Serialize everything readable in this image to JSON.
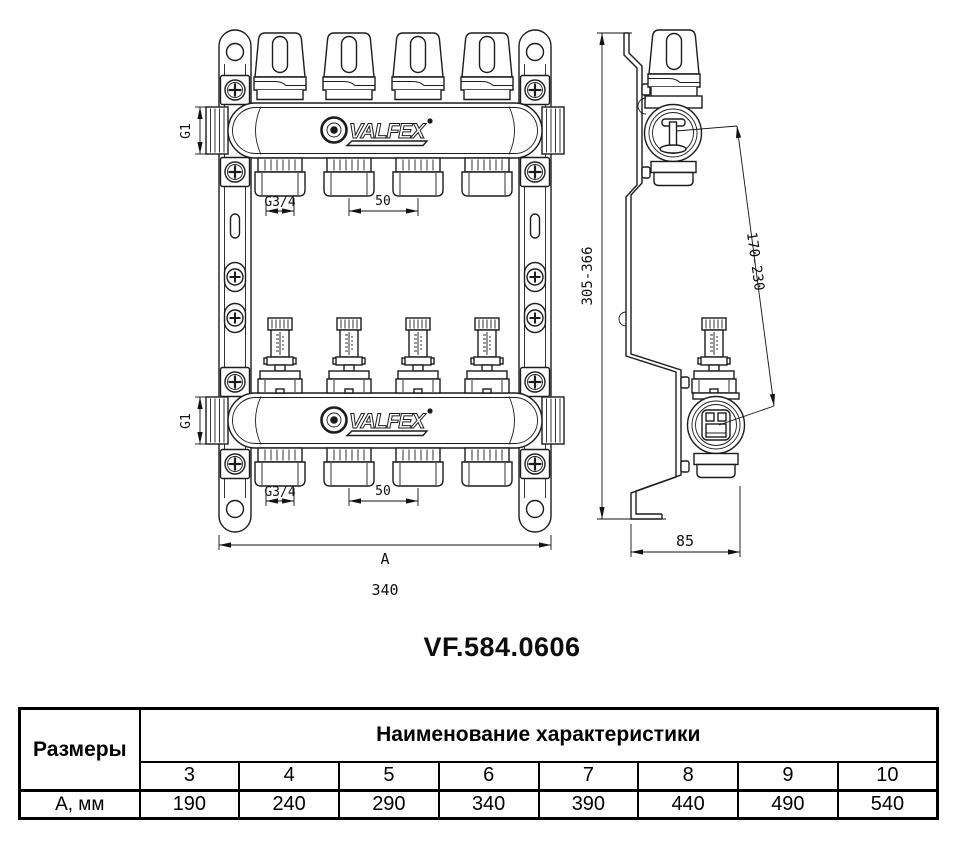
{
  "title": "VF.584.0606",
  "drawing": {
    "logo_text": "VALFEX",
    "dims": {
      "g1": "G1",
      "g34": "G3/4",
      "spacing": "50",
      "width_letter": "A",
      "width_value": "340",
      "height_range": "305-366",
      "depth_range": "170-230",
      "bracket_depth": "85"
    }
  },
  "table": {
    "row_header": "Размеры",
    "col_header": "Наименование характеристики",
    "sizes": [
      "3",
      "4",
      "5",
      "6",
      "7",
      "8",
      "9",
      "10"
    ],
    "row_label": "А, мм",
    "values": [
      "190",
      "240",
      "290",
      "340",
      "390",
      "440",
      "490",
      "540"
    ]
  }
}
